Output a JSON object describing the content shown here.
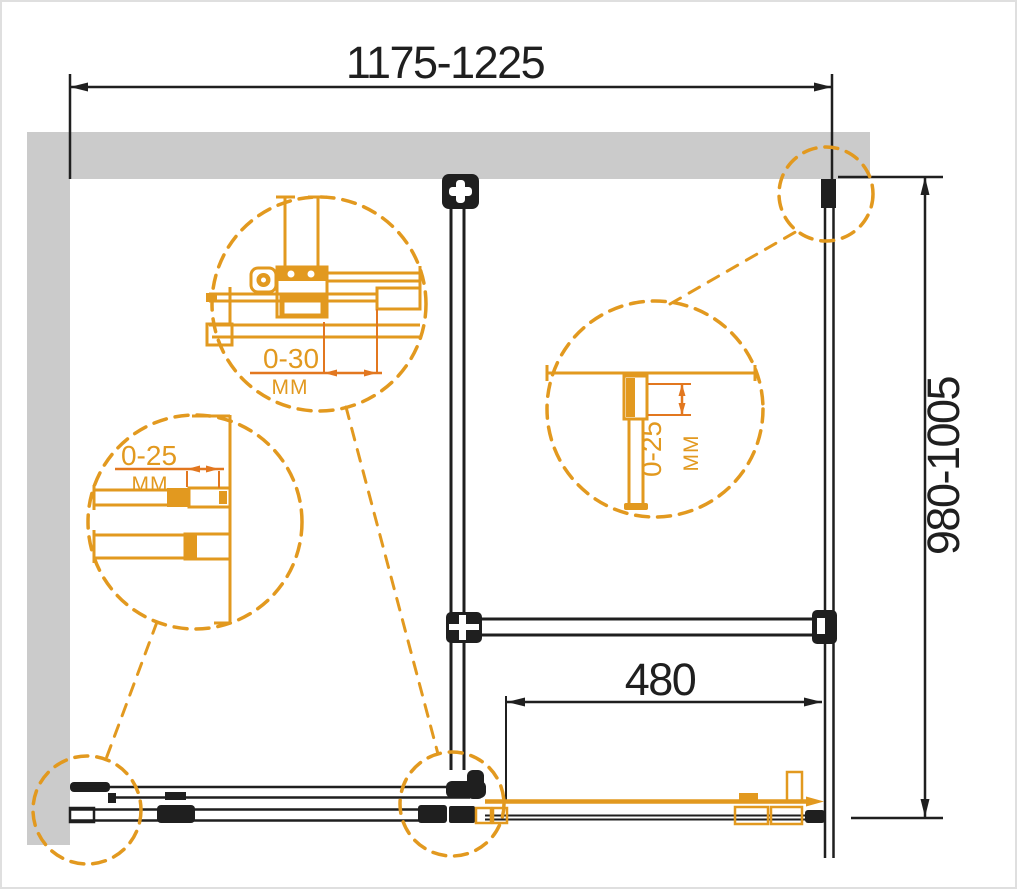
{
  "colors": {
    "line": "#1f1f1f",
    "wall": "#cbcbcb",
    "accent": "#e2991f",
    "accentdim": "#e2771f"
  },
  "dimensions": {
    "overall_width": {
      "label": "1175-1225"
    },
    "overall_depth": {
      "label": "980-1005"
    },
    "door_travel": {
      "label": "480"
    }
  },
  "details": {
    "top_bracket_adjust": {
      "range": "0-30",
      "unit": "MM"
    },
    "left_profile_adjust": {
      "range": "0-25",
      "unit": "MM"
    },
    "mid_profile_adjust": {
      "range": "0-25",
      "unit": "MM"
    }
  }
}
